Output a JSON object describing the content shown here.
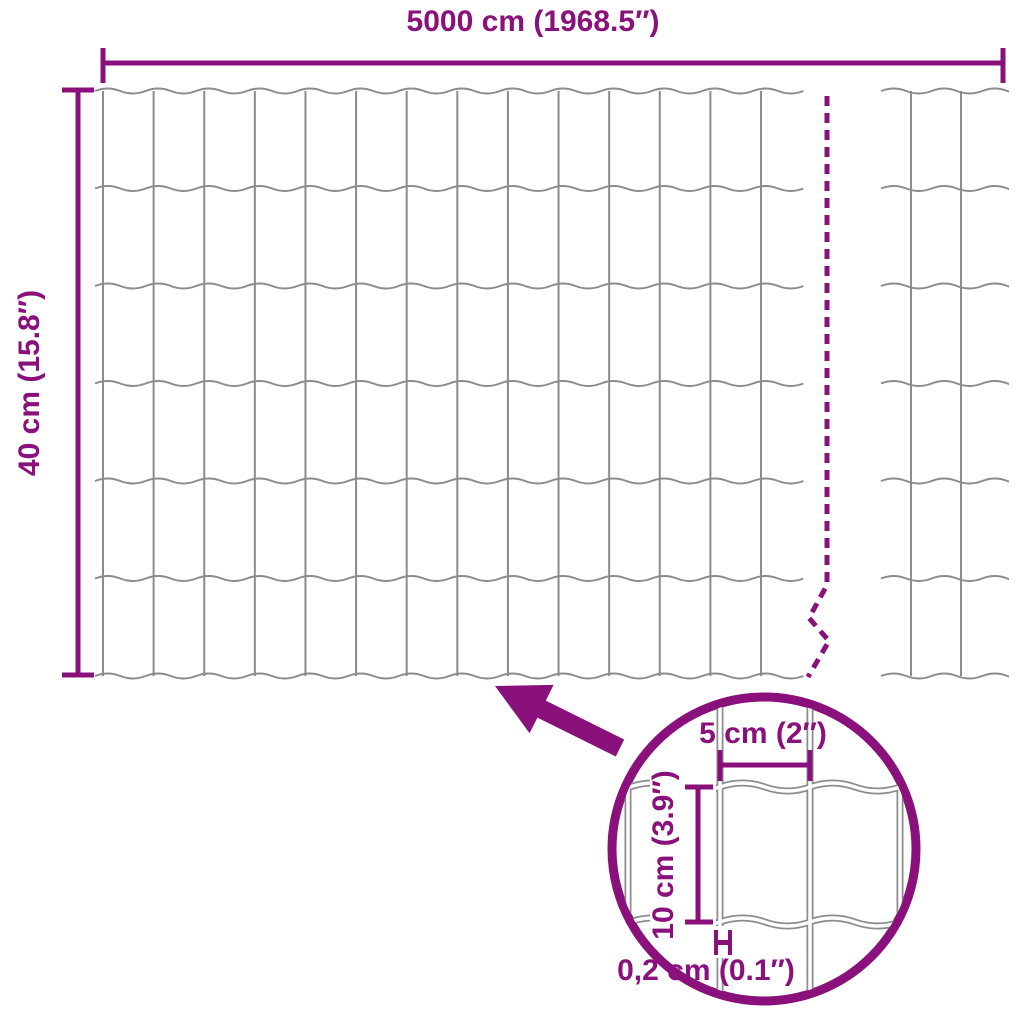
{
  "labels": {
    "total_width": "5000 cm (1968.5″)",
    "total_height": "40 cm (15.8″)",
    "mesh_cell_width": "5 cm (2″)",
    "mesh_cell_height": "10 cm (3.9″)",
    "wire_thickness": "0,2 cm (0.1″)"
  },
  "colors": {
    "accent": "#8A107C",
    "wire": "#8C8C8C",
    "background": "#FFFFFF"
  }
}
